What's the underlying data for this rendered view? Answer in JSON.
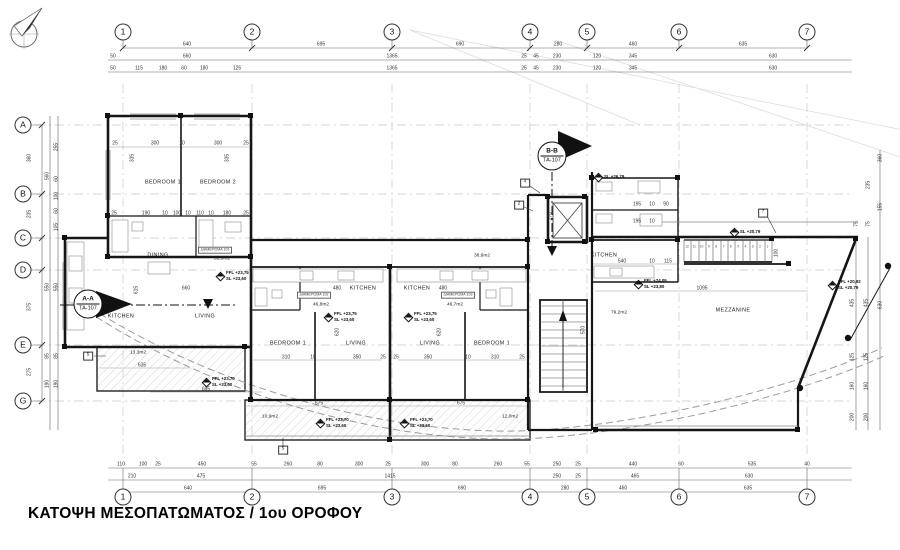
{
  "title": "ΚΑΤΟΨΗ ΜΕΣΟΠΑΤΩΜΑΤΟΣ / 1ου ΟΡΟΦΟΥ",
  "colors": {
    "paper": "#ffffff",
    "line": "#1a1a1a",
    "dim_text": "#333333",
    "grid_line": "#c9c9c9",
    "hatch": "#c4c4c4"
  },
  "icons": {
    "north_arrow": "compass-north-needle",
    "level_marker": "half-filled-diamond"
  },
  "grid": {
    "top_y": 32,
    "bottom_y": 497,
    "left_x": 23,
    "cols": [
      {
        "label": "1",
        "x": 123
      },
      {
        "label": "2",
        "x": 252
      },
      {
        "label": "3",
        "x": 392
      },
      {
        "label": "4",
        "x": 530
      },
      {
        "label": "5",
        "x": 587
      },
      {
        "label": "6",
        "x": 679
      },
      {
        "label": "7",
        "x": 807
      }
    ],
    "rows": [
      {
        "label": "A",
        "y": 125
      },
      {
        "label": "B",
        "y": 194
      },
      {
        "label": "C",
        "y": 238
      },
      {
        "label": "D",
        "y": 270
      },
      {
        "label": "E",
        "y": 345
      },
      {
        "label": "G",
        "y": 401
      }
    ]
  },
  "dims": {
    "top": [
      {
        "t": "640",
        "x": 187,
        "y": 45
      },
      {
        "t": "695",
        "x": 321,
        "y": 45
      },
      {
        "t": "690",
        "x": 460,
        "y": 45
      },
      {
        "t": "280",
        "x": 558,
        "y": 45
      },
      {
        "t": "460",
        "x": 633,
        "y": 45
      },
      {
        "t": "635",
        "x": 743,
        "y": 45
      },
      {
        "t": "50",
        "x": 113,
        "y": 57
      },
      {
        "t": "660",
        "x": 187,
        "y": 57
      },
      {
        "t": "1365",
        "x": 392,
        "y": 57
      },
      {
        "t": "25",
        "x": 524,
        "y": 57
      },
      {
        "t": "45",
        "x": 536,
        "y": 57
      },
      {
        "t": "230",
        "x": 557,
        "y": 57
      },
      {
        "t": "120",
        "x": 597,
        "y": 57
      },
      {
        "t": "345",
        "x": 633,
        "y": 57
      },
      {
        "t": "630",
        "x": 773,
        "y": 57
      },
      {
        "t": "50",
        "x": 113,
        "y": 69
      },
      {
        "t": "115",
        "x": 139,
        "y": 69
      },
      {
        "t": "180",
        "x": 163,
        "y": 69
      },
      {
        "t": "60",
        "x": 184,
        "y": 69
      },
      {
        "t": "180",
        "x": 204,
        "y": 69
      },
      {
        "t": "125",
        "x": 237,
        "y": 69
      },
      {
        "t": "1365",
        "x": 392,
        "y": 69
      },
      {
        "t": "25",
        "x": 524,
        "y": 69
      },
      {
        "t": "45",
        "x": 536,
        "y": 69
      },
      {
        "t": "230",
        "x": 557,
        "y": 69
      },
      {
        "t": "120",
        "x": 597,
        "y": 69
      },
      {
        "t": "345",
        "x": 633,
        "y": 69
      },
      {
        "t": "630",
        "x": 773,
        "y": 69
      }
    ],
    "bottom": [
      {
        "t": "110",
        "x": 121,
        "y": 465
      },
      {
        "t": "100",
        "x": 143,
        "y": 465
      },
      {
        "t": "25",
        "x": 158,
        "y": 465
      },
      {
        "t": "450",
        "x": 202,
        "y": 465
      },
      {
        "t": "55",
        "x": 254,
        "y": 465
      },
      {
        "t": "260",
        "x": 288,
        "y": 465
      },
      {
        "t": "80",
        "x": 320,
        "y": 465
      },
      {
        "t": "300",
        "x": 359,
        "y": 465
      },
      {
        "t": "25",
        "x": 388,
        "y": 465
      },
      {
        "t": "300",
        "x": 425,
        "y": 465
      },
      {
        "t": "80",
        "x": 455,
        "y": 465
      },
      {
        "t": "260",
        "x": 498,
        "y": 465
      },
      {
        "t": "55",
        "x": 527,
        "y": 465
      },
      {
        "t": "250",
        "x": 557,
        "y": 465
      },
      {
        "t": "25",
        "x": 578,
        "y": 465
      },
      {
        "t": "440",
        "x": 633,
        "y": 465
      },
      {
        "t": "60",
        "x": 681,
        "y": 465
      },
      {
        "t": "535",
        "x": 752,
        "y": 465
      },
      {
        "t": "40",
        "x": 807,
        "y": 465
      },
      {
        "t": "210",
        "x": 132,
        "y": 477
      },
      {
        "t": "475",
        "x": 201,
        "y": 477
      },
      {
        "t": "1415",
        "x": 390,
        "y": 477
      },
      {
        "t": "250",
        "x": 557,
        "y": 477
      },
      {
        "t": "25",
        "x": 578,
        "y": 477
      },
      {
        "t": "465",
        "x": 635,
        "y": 477
      },
      {
        "t": "630",
        "x": 749,
        "y": 477
      },
      {
        "t": "640",
        "x": 188,
        "y": 489
      },
      {
        "t": "695",
        "x": 322,
        "y": 489
      },
      {
        "t": "690",
        "x": 462,
        "y": 489
      },
      {
        "t": "280",
        "x": 565,
        "y": 489
      },
      {
        "t": "460",
        "x": 623,
        "y": 489
      },
      {
        "t": "635",
        "x": 748,
        "y": 489
      }
    ],
    "left": [
      {
        "t": "360",
        "x": 30,
        "y": 158,
        "r": -90
      },
      {
        "t": "235",
        "x": 30,
        "y": 214,
        "r": -90
      },
      {
        "t": "375",
        "x": 30,
        "y": 307,
        "r": -90
      },
      {
        "t": "275",
        "x": 30,
        "y": 372,
        "r": -90
      },
      {
        "t": "560",
        "x": 48,
        "y": 176,
        "r": -90
      },
      {
        "t": "550",
        "x": 48,
        "y": 287,
        "r": -90
      },
      {
        "t": "85",
        "x": 48,
        "y": 356,
        "r": -90
      },
      {
        "t": "190",
        "x": 48,
        "y": 384,
        "r": -90
      },
      {
        "t": "255",
        "x": 57,
        "y": 147,
        "r": -90
      },
      {
        "t": "60",
        "x": 57,
        "y": 179,
        "r": -90
      },
      {
        "t": "100",
        "x": 57,
        "y": 196,
        "r": -90
      },
      {
        "t": "60",
        "x": 57,
        "y": 211,
        "r": -90
      },
      {
        "t": "105",
        "x": 57,
        "y": 227,
        "r": -90
      },
      {
        "t": "550",
        "x": 57,
        "y": 287,
        "r": -90
      },
      {
        "t": "85",
        "x": 57,
        "y": 356,
        "r": -90
      },
      {
        "t": "190",
        "x": 57,
        "y": 384,
        "r": -90
      }
    ],
    "right": [
      {
        "t": "360",
        "x": 881,
        "y": 158,
        "r": -90
      },
      {
        "t": "155",
        "x": 881,
        "y": 207,
        "r": -90
      },
      {
        "t": "235",
        "x": 869,
        "y": 185,
        "r": -90
      },
      {
        "t": "75",
        "x": 869,
        "y": 224,
        "r": -90
      },
      {
        "t": "75",
        "x": 857,
        "y": 224,
        "r": -90
      },
      {
        "t": "435",
        "x": 853,
        "y": 303,
        "r": -90
      },
      {
        "t": "435",
        "x": 867,
        "y": 303,
        "r": -90
      },
      {
        "t": "630",
        "x": 881,
        "y": 305,
        "r": -90
      },
      {
        "t": "125",
        "x": 853,
        "y": 357,
        "r": -90
      },
      {
        "t": "125",
        "x": 867,
        "y": 357,
        "r": -90
      },
      {
        "t": "160",
        "x": 853,
        "y": 386,
        "r": -90
      },
      {
        "t": "160",
        "x": 867,
        "y": 386,
        "r": -90
      },
      {
        "t": "200",
        "x": 853,
        "y": 417,
        "r": -90
      },
      {
        "t": "200",
        "x": 867,
        "y": 417,
        "r": -90
      }
    ],
    "plan": [
      {
        "t": "25",
        "x": 115,
        "y": 144
      },
      {
        "t": "300",
        "x": 155,
        "y": 144
      },
      {
        "t": "10",
        "x": 182,
        "y": 144
      },
      {
        "t": "300",
        "x": 218,
        "y": 144
      },
      {
        "t": "25",
        "x": 246,
        "y": 144
      },
      {
        "t": "335",
        "x": 133,
        "y": 158,
        "r": -90
      },
      {
        "t": "335",
        "x": 228,
        "y": 158,
        "r": -90
      },
      {
        "t": "25",
        "x": 114,
        "y": 214
      },
      {
        "t": "190",
        "x": 146,
        "y": 214
      },
      {
        "t": "10",
        "x": 165,
        "y": 214
      },
      {
        "t": "100",
        "x": 177,
        "y": 214
      },
      {
        "t": "10",
        "x": 188,
        "y": 214
      },
      {
        "t": "110",
        "x": 200,
        "y": 214
      },
      {
        "t": "10",
        "x": 211,
        "y": 214
      },
      {
        "t": "180",
        "x": 227,
        "y": 214
      },
      {
        "t": "25",
        "x": 246,
        "y": 214
      },
      {
        "t": "615",
        "x": 137,
        "y": 290,
        "r": -90
      },
      {
        "t": "660",
        "x": 186,
        "y": 289
      },
      {
        "t": "635",
        "x": 142,
        "y": 366
      },
      {
        "t": "695",
        "x": 206,
        "y": 390
      },
      {
        "t": "480",
        "x": 337,
        "y": 289
      },
      {
        "t": "480",
        "x": 443,
        "y": 289
      },
      {
        "t": "310",
        "x": 286,
        "y": 358
      },
      {
        "t": "10",
        "x": 313,
        "y": 358
      },
      {
        "t": "350",
        "x": 357,
        "y": 358
      },
      {
        "t": "25",
        "x": 383,
        "y": 358
      },
      {
        "t": "25",
        "x": 396,
        "y": 358
      },
      {
        "t": "350",
        "x": 428,
        "y": 358
      },
      {
        "t": "10",
        "x": 468,
        "y": 358
      },
      {
        "t": "310",
        "x": 495,
        "y": 358
      },
      {
        "t": "25",
        "x": 522,
        "y": 358
      },
      {
        "t": "620",
        "x": 338,
        "y": 332,
        "r": -90
      },
      {
        "t": "620",
        "x": 440,
        "y": 332,
        "r": -90
      },
      {
        "t": "675",
        "x": 319,
        "y": 404
      },
      {
        "t": "675",
        "x": 461,
        "y": 404
      },
      {
        "t": "270",
        "x": 551,
        "y": 216,
        "r": -90
      },
      {
        "t": "570",
        "x": 584,
        "y": 330,
        "r": -90
      },
      {
        "t": "195",
        "x": 637,
        "y": 205
      },
      {
        "t": "10",
        "x": 652,
        "y": 205
      },
      {
        "t": "90",
        "x": 666,
        "y": 205
      },
      {
        "t": "195",
        "x": 637,
        "y": 222
      },
      {
        "t": "10",
        "x": 652,
        "y": 222
      },
      {
        "t": "540",
        "x": 622,
        "y": 262
      },
      {
        "t": "10",
        "x": 652,
        "y": 262
      },
      {
        "t": "115",
        "x": 668,
        "y": 262
      },
      {
        "t": "100",
        "x": 777,
        "y": 253,
        "r": -90
      },
      {
        "t": "1095",
        "x": 702,
        "y": 289
      }
    ]
  },
  "rooms": [
    {
      "t": "BEDROOM 1",
      "x": 163,
      "y": 183
    },
    {
      "t": "BEDROOM 2",
      "x": 218,
      "y": 183
    },
    {
      "t": "DINING",
      "x": 158,
      "y": 256
    },
    {
      "t": "KITCHEN",
      "x": 121,
      "y": 317
    },
    {
      "t": "LIVING",
      "x": 205,
      "y": 317
    },
    {
      "t": "KITCHEN",
      "x": 363,
      "y": 289
    },
    {
      "t": "KITCHEN",
      "x": 417,
      "y": 289
    },
    {
      "t": "BEDROOM 1",
      "x": 288,
      "y": 344
    },
    {
      "t": "LIVING",
      "x": 356,
      "y": 344
    },
    {
      "t": "LIVING",
      "x": 430,
      "y": 344
    },
    {
      "t": "BEDROOM 1",
      "x": 492,
      "y": 344
    },
    {
      "t": "KITCHEN",
      "x": 604,
      "y": 256
    },
    {
      "t": "MEZZANINE",
      "x": 733,
      "y": 311
    }
  ],
  "areas": [
    {
      "t": "81,0m2",
      "x": 222,
      "y": 260
    },
    {
      "t": "13,3m2",
      "x": 138,
      "y": 354
    },
    {
      "t": "38,6m2",
      "x": 482,
      "y": 257
    },
    {
      "t": "46,8m2",
      "x": 321,
      "y": 306
    },
    {
      "t": "46,7m2",
      "x": 455,
      "y": 306
    },
    {
      "t": "10,9m2",
      "x": 270,
      "y": 418
    },
    {
      "t": "12,0m2",
      "x": 510,
      "y": 418
    },
    {
      "t": "79,2m2",
      "x": 619,
      "y": 314
    }
  ],
  "apartments": [
    {
      "t": "ΔΙΑΜΕΡΙΣΜΑ 101",
      "x": 215,
      "y": 250
    },
    {
      "t": "ΔΙΑΜΕΡΙΣΜΑ 102",
      "x": 314,
      "y": 295
    },
    {
      "t": "ΔΙΑΜΕΡΙΣΜΑ 103",
      "x": 458,
      "y": 295
    }
  ],
  "levels": [
    {
      "lines": [
        "FFL +23,75",
        "SL +23,60"
      ],
      "x": 226,
      "y": 276
    },
    {
      "lines": [
        "FFL +23,75",
        "SL +23,60"
      ],
      "x": 334,
      "y": 317
    },
    {
      "lines": [
        "FFL +23,75",
        "SL +23,60"
      ],
      "x": 414,
      "y": 317
    },
    {
      "lines": [
        "FFL +23,70",
        "SL +23,60"
      ],
      "x": 212,
      "y": 382
    },
    {
      "lines": [
        "FFL +23,70",
        "SL +23,60"
      ],
      "x": 326,
      "y": 423
    },
    {
      "lines": [
        "FFL +23,70",
        "SL +23,60"
      ],
      "x": 410,
      "y": 423
    },
    {
      "lines": [
        "FFL +24,05",
        "SL +23,80"
      ],
      "x": 644,
      "y": 284
    },
    {
      "lines": [
        "SL +26,79"
      ],
      "x": 604,
      "y": 177
    },
    {
      "lines": [
        "SL +20,79"
      ],
      "x": 740,
      "y": 232
    },
    {
      "lines": [
        "FFL +20,92",
        "SL +20,79"
      ],
      "x": 838,
      "y": 285
    }
  ],
  "sections": {
    "aa": {
      "label": "A-A",
      "ref": "ΤΑ-107",
      "x": 88,
      "y": 304
    },
    "bb": {
      "label": "B-B",
      "ref": "ΤΑ-107",
      "x": 552,
      "y": 156
    }
  },
  "ref_boxes": [
    {
      "t": "5",
      "x": 88,
      "y": 356
    },
    {
      "t": "5",
      "x": 283,
      "y": 450
    },
    {
      "t": "4",
      "x": 525,
      "y": 183
    },
    {
      "t": "2",
      "x": 519,
      "y": 205
    },
    {
      "t": "7",
      "x": 763,
      "y": 213
    }
  ],
  "stairs": {
    "x0": 687,
    "dx": 7.3,
    "y": 247,
    "numbers": [
      "12",
      "11",
      "10",
      "9",
      "8",
      "7",
      "6",
      "5",
      "4",
      "3",
      "2",
      "1"
    ]
  }
}
